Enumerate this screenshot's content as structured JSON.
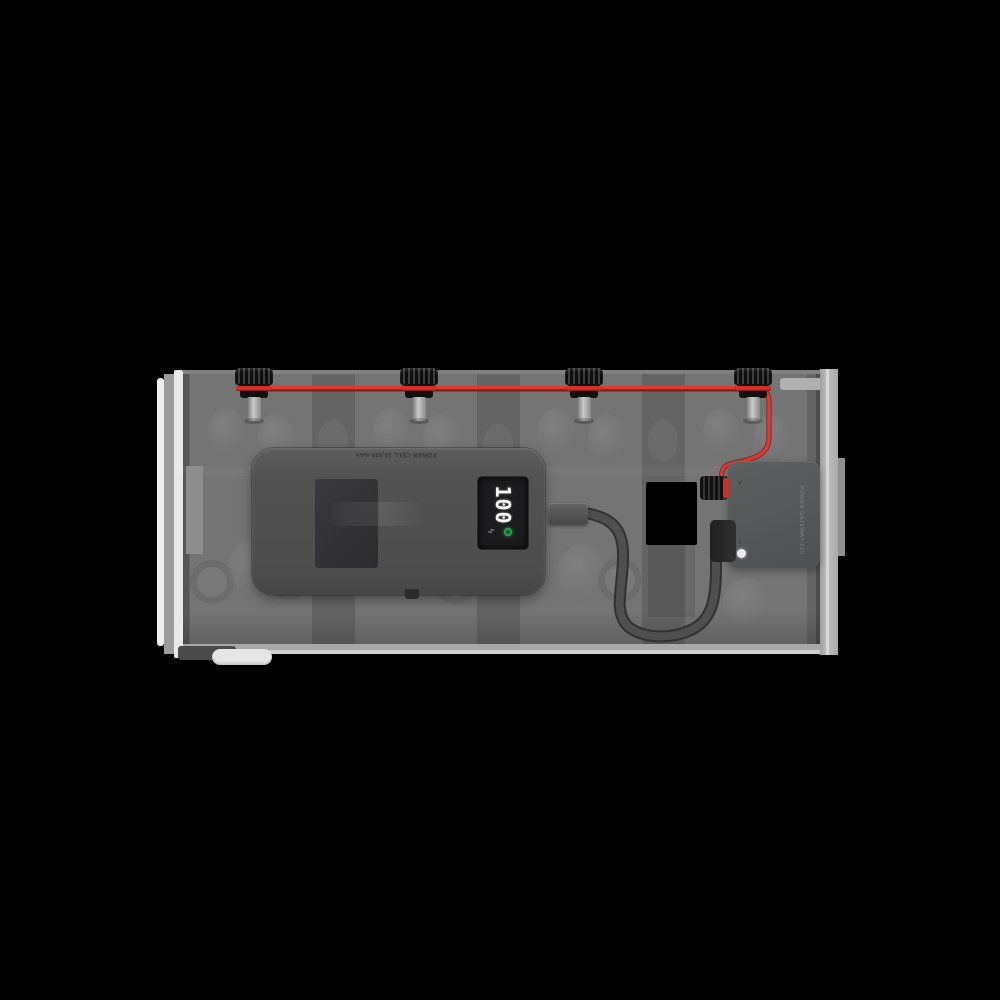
{
  "scene": {
    "description": "Product render on black: translucent battery box with four knurled terminal caps linked by a red wire; an upside-down power bank inside shows 100 on its display and is cabled to a POWER GATEWAY module wired to the right-most terminal cap.",
    "background_color": "#000000"
  },
  "power_bank": {
    "top_label": "POWER CELL 10,000 mAh",
    "display_value": "100",
    "bolt_glyph": "ϟ",
    "led_color": "#2fae52"
  },
  "gateway": {
    "side_label": "POWER GATEWAY 12V",
    "chevron_top": "‹",
    "chevron_bottom": "›",
    "led_color": "#ececec"
  },
  "wiring": {
    "wire_color": "#dd3a31",
    "cable_color": "#4f4f4f"
  },
  "terminal_caps": {
    "count": 4,
    "red_band_color": "#d2312d"
  }
}
